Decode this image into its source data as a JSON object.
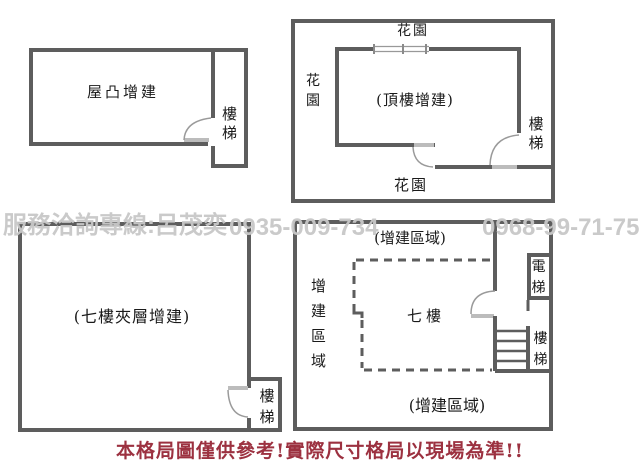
{
  "watermark": {
    "hotline": "服務洽詢專線:呂茂奕",
    "phone_1": "0935-009-734",
    "phone_2": "0968-99-71-75"
  },
  "disclaimer": {
    "text": "本格局圖僅供參考!實際尺寸格局以現場為準!!"
  },
  "plans": {
    "rooftop": {
      "room": "屋凸增建",
      "stairs": "樓梯"
    },
    "top_floor": {
      "garden_top": "花園",
      "garden_left": "花園",
      "garden_bottom": "花園",
      "room": "(頂樓增建)",
      "stairs": "樓梯"
    },
    "mezzanine": {
      "room": "(七樓夾層增建)",
      "stairs": "樓梯"
    },
    "seventh_floor": {
      "area_top": "(增建區域)",
      "area_left": "增建區域",
      "area_bottom": "(增建區域)",
      "room": "七樓",
      "elevator": "電梯",
      "stairs": "樓梯"
    }
  },
  "colors": {
    "wall": "#5d5d5d",
    "door_arc": "#9a9a9a",
    "door_sill": "#bcbcbc",
    "watermark": "#c8c8c8",
    "disclaimer_text": "#9c3140",
    "label_text": "#1a1a1a",
    "background": "#ffffff"
  }
}
